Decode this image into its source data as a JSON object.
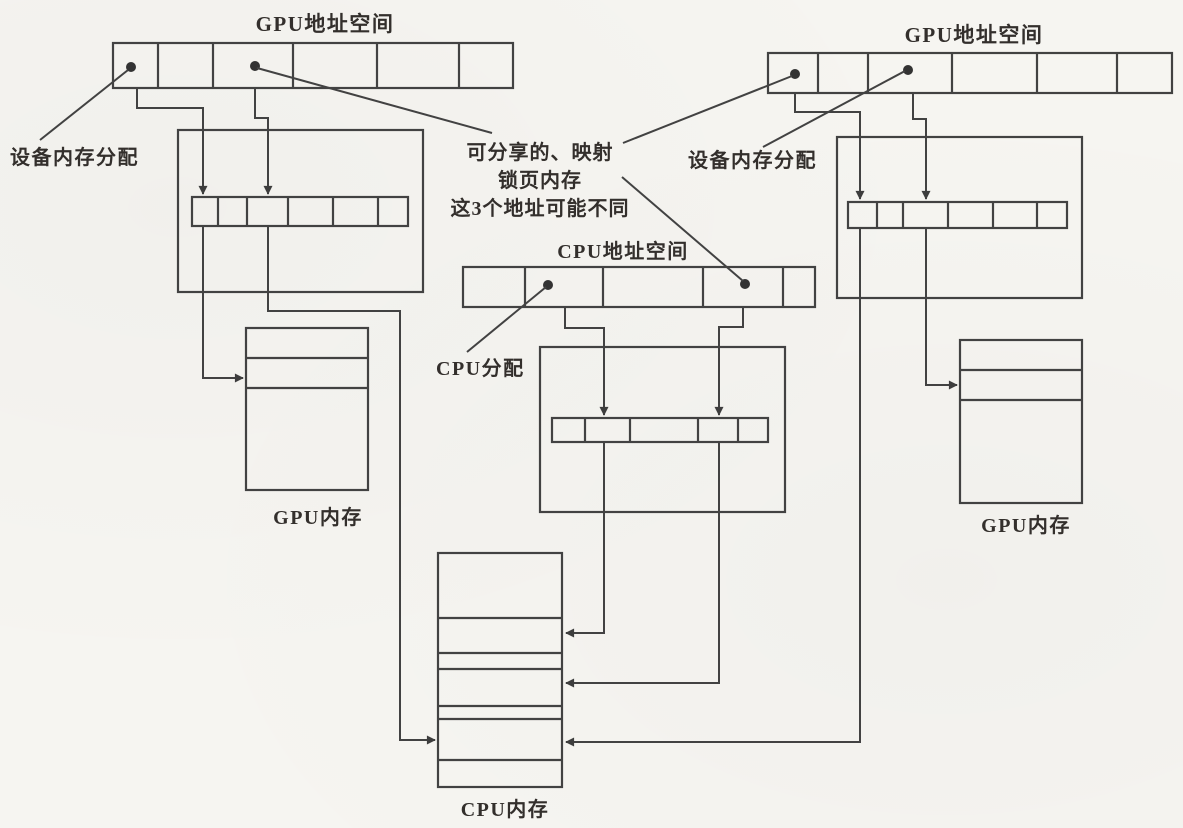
{
  "figure": {
    "background": "#f6f5f1",
    "line_color": "#424242",
    "text_color": "#332f2c",
    "labels": {
      "gpu_space_left": "GPU地址空间",
      "gpu_space_right": "GPU地址空间",
      "device_alloc_left": "设备内存分配",
      "device_alloc_right": "设备内存分配",
      "note_line1": "可分享的、映射",
      "note_line2": "锁页内存",
      "note_line3": "这3个地址可能不同",
      "cpu_space": "CPU地址空间",
      "cpu_alloc": "CPU分配",
      "gpu_mem_left": "GPU内存",
      "gpu_mem_right": "GPU内存",
      "cpu_mem": "CPU内存"
    }
  }
}
